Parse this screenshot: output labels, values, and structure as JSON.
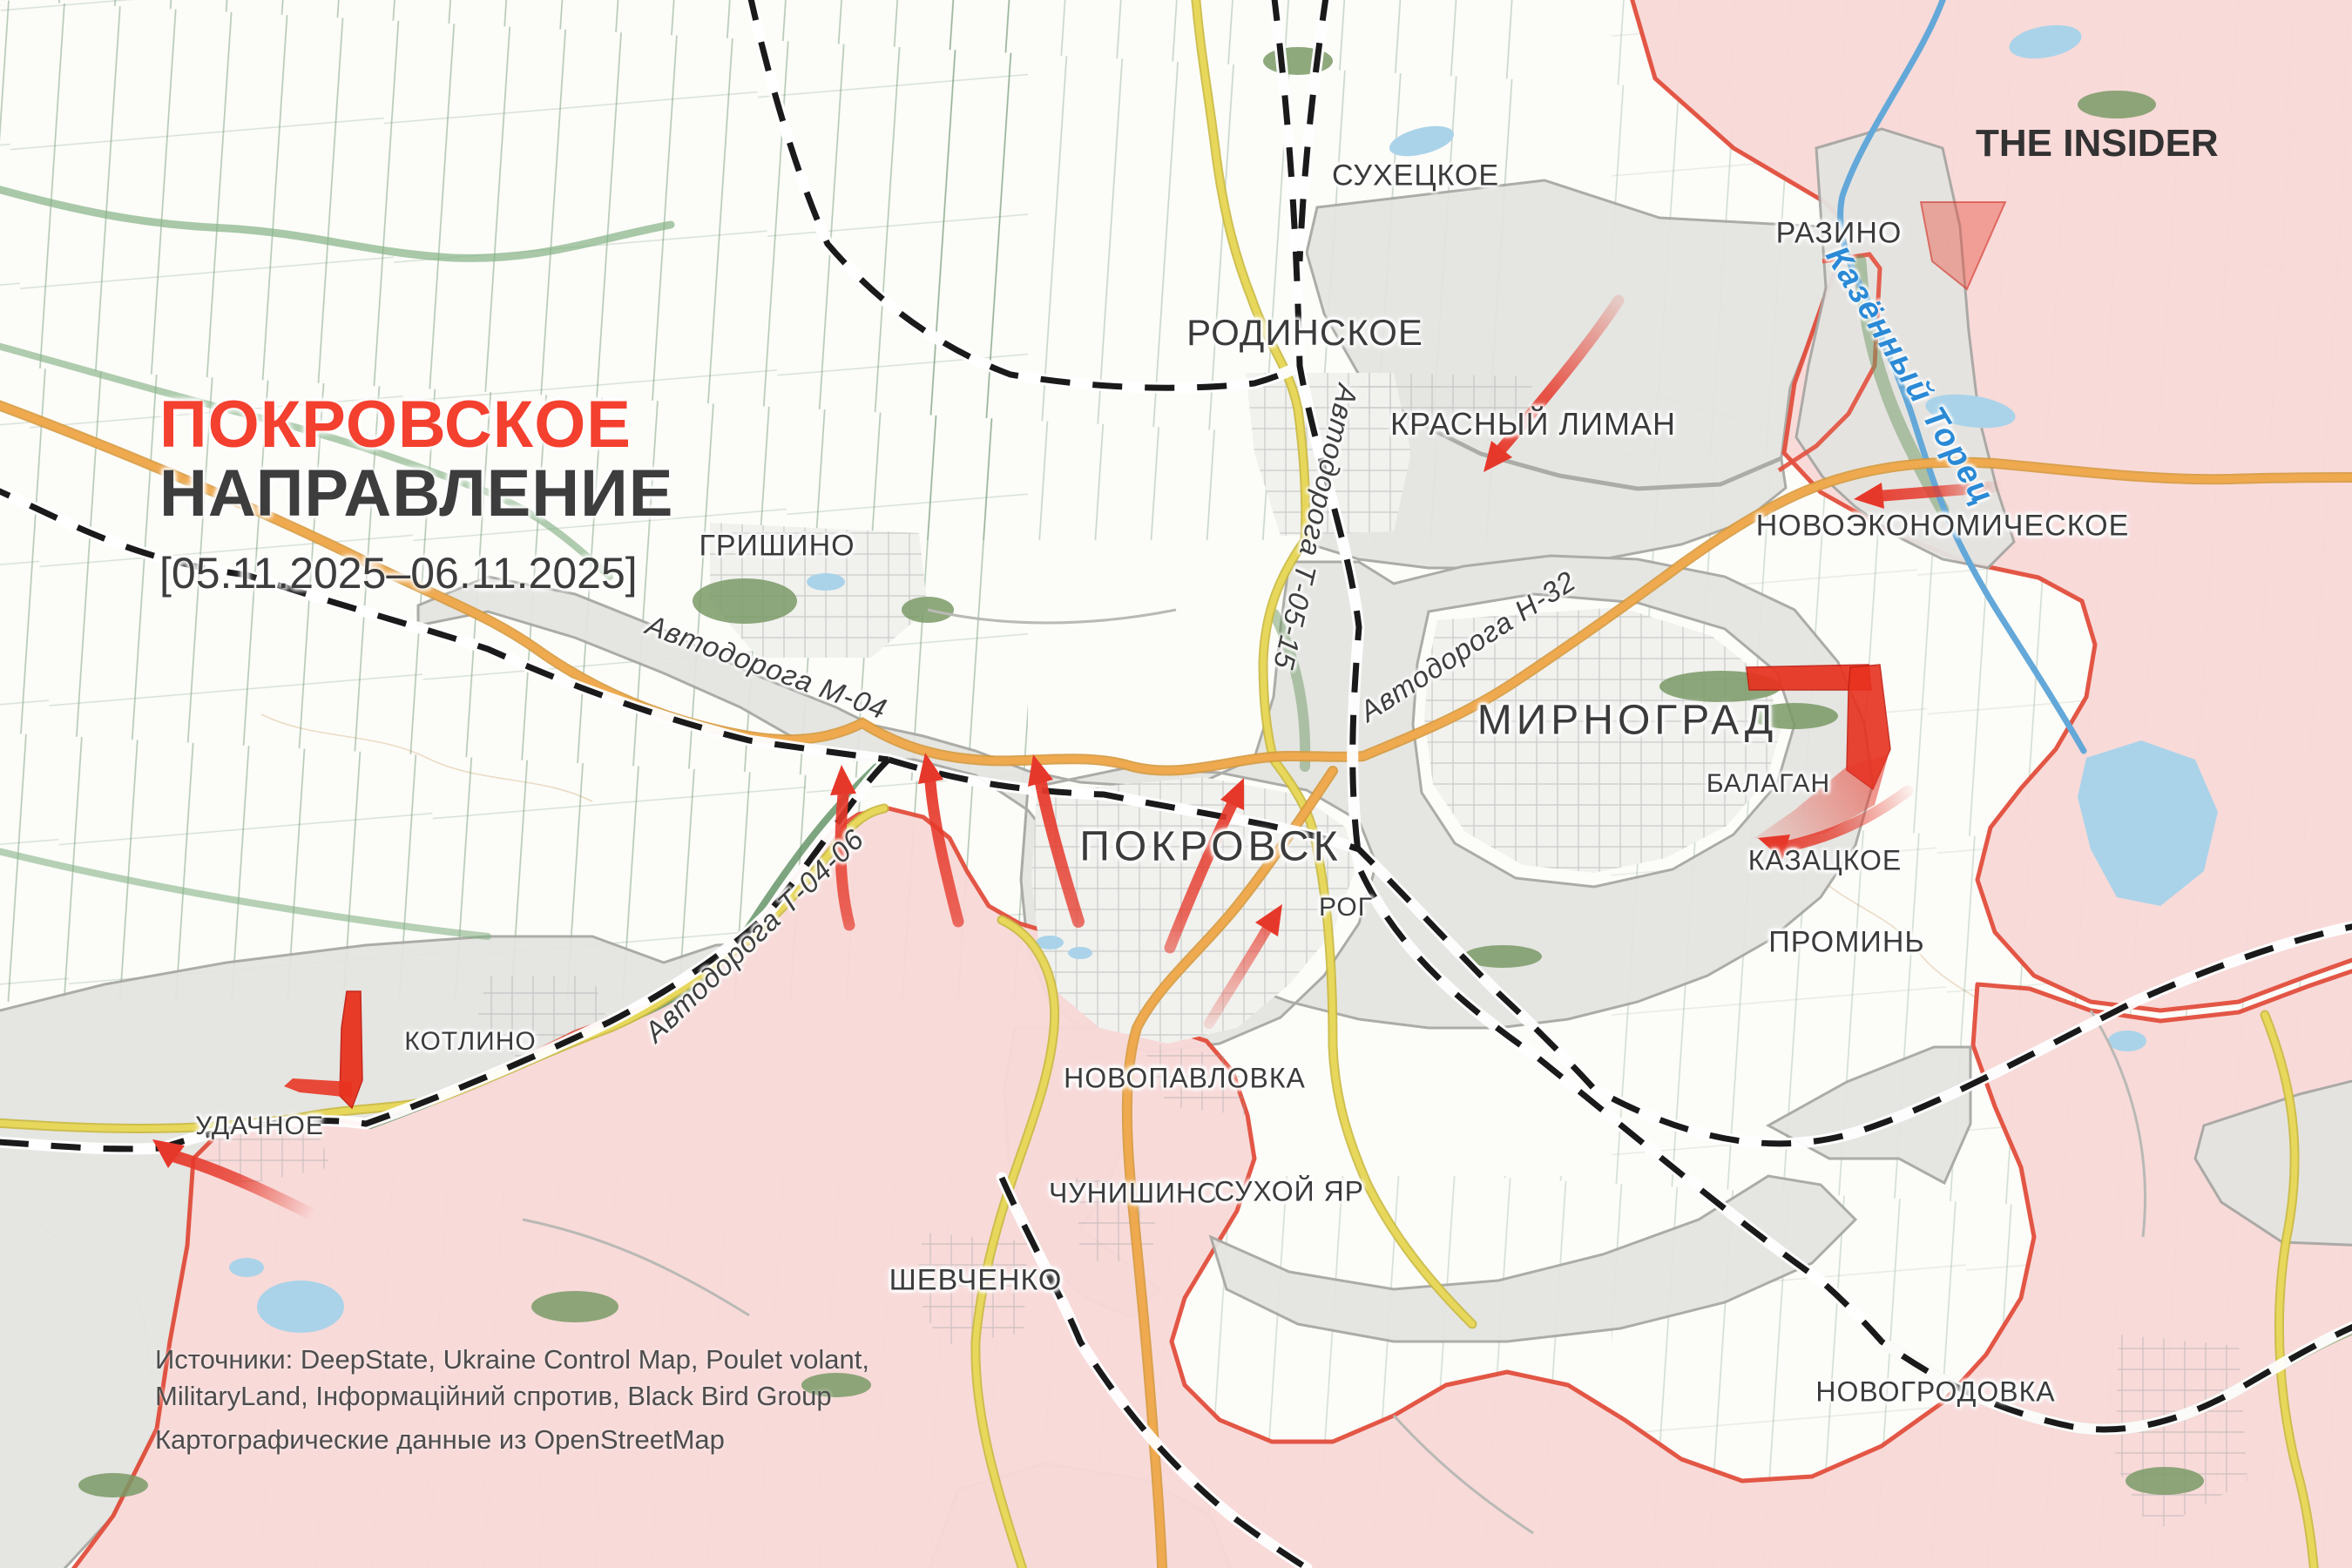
{
  "title": {
    "line1": "ПОКРОВСКОЕ",
    "line2": "НАПРАВЛЕНИЕ",
    "date_range": "[05.11.2025–06.11.2025]"
  },
  "branding": {
    "logo": "THE INSIDER"
  },
  "settlements": [
    {
      "name": "СУХЕЦКОЕ"
    },
    {
      "name": "РОДИНСКОЕ"
    },
    {
      "name": "РАЗИНО"
    },
    {
      "name": "КРАСНЫЙ ЛИМАН"
    },
    {
      "name": "НОВОЭКОНОМИЧЕСКОЕ"
    },
    {
      "name": "ГРИШИНО"
    },
    {
      "name": "МИРНОГРАД"
    },
    {
      "name": "ПОКРОВСК"
    },
    {
      "name": "РОГ"
    },
    {
      "name": "БАЛАГАН"
    },
    {
      "name": "КАЗАЦКОЕ"
    },
    {
      "name": "ПРОМИНЬ"
    },
    {
      "name": "КОТЛИНО"
    },
    {
      "name": "УДАЧНОЕ"
    },
    {
      "name": "НОВОПАВЛОВКА"
    },
    {
      "name": "ЧУНИШИНО"
    },
    {
      "name": "СУХОЙ ЯР"
    },
    {
      "name": "ШЕВЧЕНКО"
    },
    {
      "name": "НОВОГРОДОВКА"
    }
  ],
  "road_labels": [
    {
      "name": "Автодорога М-04"
    },
    {
      "name": "Автодорога Т-04-06"
    },
    {
      "name": "Автодорога Т-05-15"
    },
    {
      "name": "Автодорога Н-32"
    }
  ],
  "river_label": {
    "name": "Казённый Торец"
  },
  "sources": {
    "line1": "Источники: DeepState, Ukraine Control Map, Poulet volant,",
    "line2": "MilitaryLand, Інформаційний спротив, Black Bird Group",
    "line3": "Картографические данные из OpenStreetMap"
  },
  "legend": {
    "russian_controlled_area_color": "#f8d9d8",
    "contested_gray_area_color": "#e4e4e1",
    "ukrainian_area_color": "#fcfcf9",
    "frontline_border_color": "#e2503e",
    "attack_arrow_color": "#e6382a",
    "road_orange_color": "#efa94f",
    "road_yellow_color": "#e7d75b",
    "highway_dashed_color": "#1a1a1a",
    "river_color": "#63a8d8",
    "title_accent_color": "#f4402f"
  }
}
